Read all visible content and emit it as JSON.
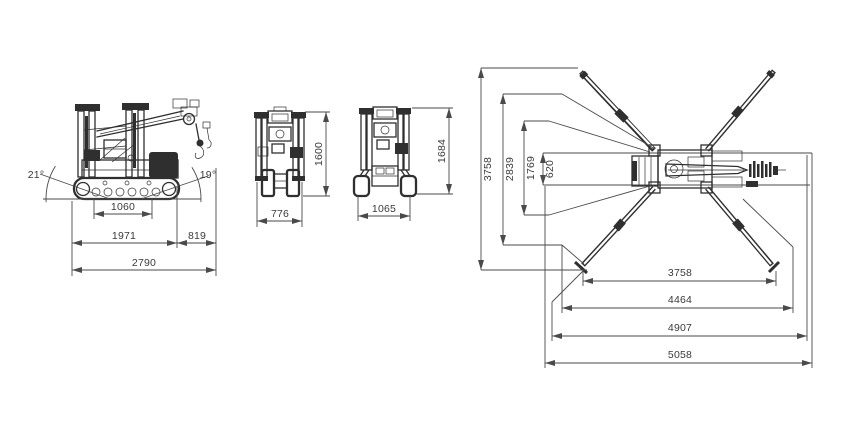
{
  "side_view": {
    "angle_left": "21°",
    "angle_right": "19°",
    "wheelbase": "1060",
    "track_length": "1971",
    "overhang": "819",
    "overall_length": "2790"
  },
  "front_view_narrow": {
    "height": "1600",
    "width": "776"
  },
  "front_view_wide": {
    "height": "1684",
    "width": "1065"
  },
  "top_view": {
    "width_outer": "3758",
    "width_mid": "2839",
    "width_inner": "1769",
    "track_width": "620",
    "length_feet": "3758",
    "length_mid": "4464",
    "length_outer": "4907",
    "length_max": "5058"
  },
  "colors": {
    "machine_line": "#2f2f2f",
    "dimension_line": "#4a4a4a",
    "text": "#3a3a3a",
    "background": "#ffffff"
  }
}
